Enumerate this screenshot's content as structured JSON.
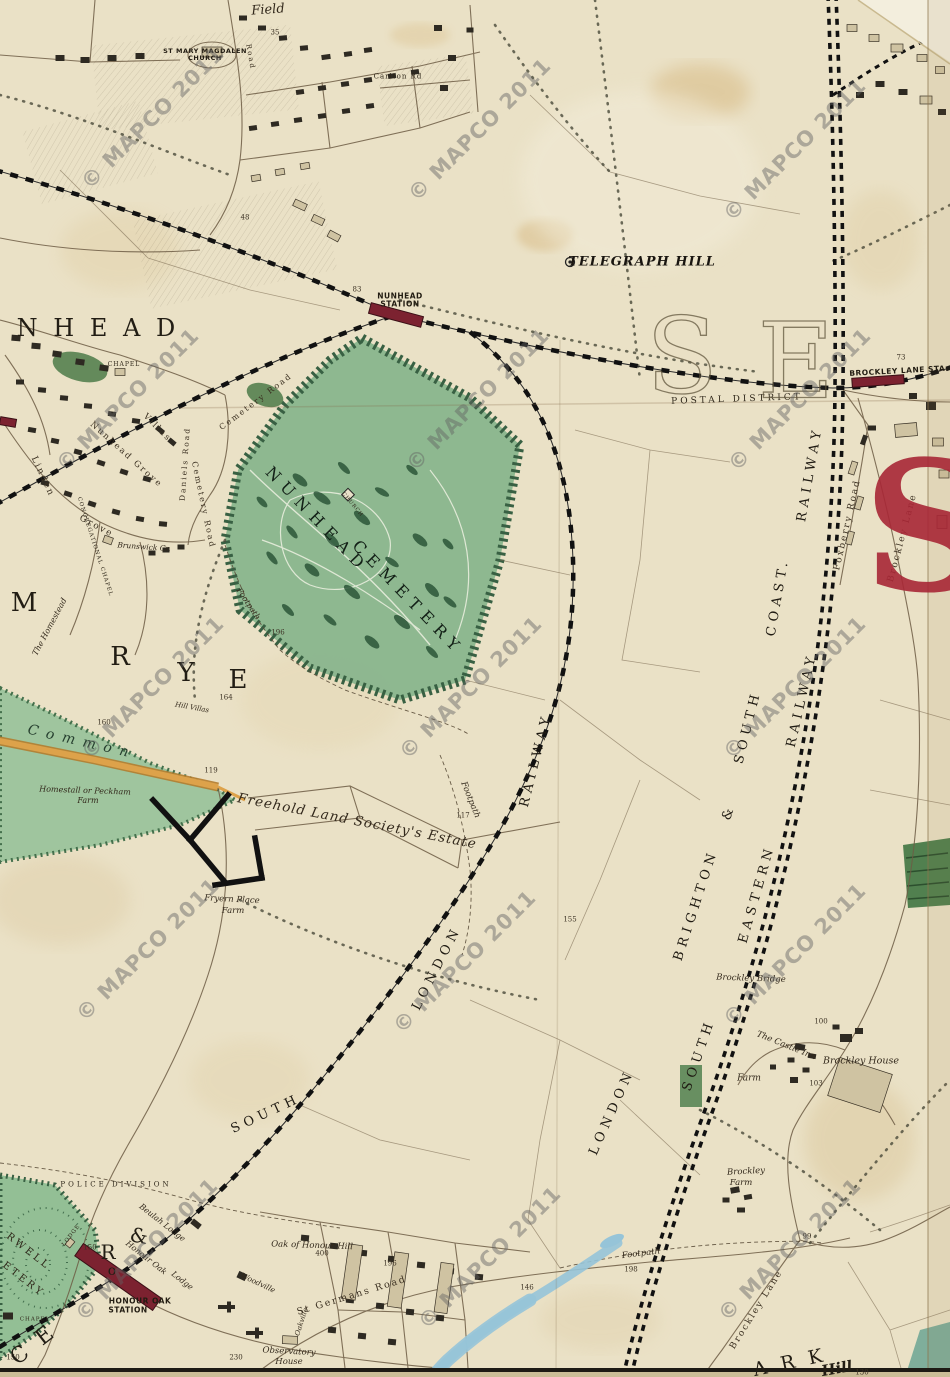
{
  "map": {
    "description": "Victorian map sheet: Nunhead / Telegraph Hill / Brockley / Honour Oak",
    "colors": {
      "paper": "#eae1c6",
      "cemetery_green": "#8ab68e",
      "common_green": "#9cc49c",
      "dark_green": "#51804f",
      "station_red": "#7c2230",
      "postal_red": "#a82736",
      "road_orange": "#d89a3c",
      "stream_blue": "#96c4d8",
      "ink": "#33291c",
      "watermark_gray": "#626262"
    },
    "watermark": {
      "text": "© MAPCO 2011",
      "positions": [
        [
          153,
          118
        ],
        [
          480,
          130
        ],
        [
          795,
          150
        ],
        [
          128,
          400
        ],
        [
          478,
          400
        ],
        [
          800,
          400
        ],
        [
          153,
          688
        ],
        [
          471,
          688
        ],
        [
          795,
          688
        ],
        [
          148,
          950
        ],
        [
          465,
          962
        ],
        [
          795,
          955
        ],
        [
          147,
          1250
        ],
        [
          490,
          1258
        ],
        [
          790,
          1250
        ]
      ]
    },
    "labels": [
      {
        "n": "field-label",
        "t": "Field",
        "x": 268,
        "y": 10,
        "r": -4,
        "s": 13,
        "c": "it"
      },
      {
        "n": "st-mary-church-label-1",
        "t": "ST MARY MAGDALEN",
        "x": 205,
        "y": 51,
        "r": 0,
        "s": 6.5,
        "c": "stn"
      },
      {
        "n": "st-mary-church-label-2",
        "t": "CHURCH",
        "x": 205,
        "y": 58,
        "r": 0,
        "s": 6.5,
        "c": "stn"
      },
      {
        "n": "road-label-nw",
        "t": "Road",
        "x": 250,
        "y": 57,
        "r": 80,
        "s": 7,
        "c": "rd"
      },
      {
        "n": "carlton-rd-label",
        "t": "Carlton Rd",
        "x": 398,
        "y": 77,
        "r": 0,
        "s": 7,
        "c": "tinycaps"
      },
      {
        "n": "num-35",
        "t": "35",
        "x": 275,
        "y": 33,
        "r": 0,
        "s": 7,
        "c": "num"
      },
      {
        "n": "num-48",
        "t": "48",
        "x": 245,
        "y": 218,
        "r": 0,
        "s": 7,
        "c": "num"
      },
      {
        "n": "telegraph-hill-label",
        "t": "TELEGRAPH HILL",
        "x": 642,
        "y": 262,
        "r": 0,
        "s": 13,
        "c": "tg"
      },
      {
        "n": "nunhead-station-label-1",
        "t": "NUNHEAD",
        "x": 400,
        "y": 296,
        "r": 0,
        "s": 7.5,
        "c": "stn"
      },
      {
        "n": "nunhead-station-label-2",
        "t": "STATION",
        "x": 400,
        "y": 304,
        "r": 0,
        "s": 7.5,
        "c": "stn"
      },
      {
        "n": "num-83",
        "t": "83",
        "x": 357,
        "y": 290,
        "r": 0,
        "s": 7,
        "c": "num"
      },
      {
        "n": "unhead-district-letters",
        "t": "U N H E A D",
        "x": 80,
        "y": 328,
        "r": 0,
        "s": 24,
        "c": "big"
      },
      {
        "n": "chapel-label-1",
        "t": "CHAPEL",
        "x": 124,
        "y": 365,
        "r": 0,
        "s": 6,
        "c": "tinycaps"
      },
      {
        "n": "brockley-lane-sta-label",
        "t": "BROCKLEY LANE STA.",
        "x": 899,
        "y": 371,
        "r": -3,
        "s": 7.5,
        "c": "stn"
      },
      {
        "n": "num-73",
        "t": "73",
        "x": 901,
        "y": 358,
        "r": 0,
        "s": 7,
        "c": "num"
      },
      {
        "n": "postal-district-label",
        "t": "POSTAL DISTRICT",
        "x": 737,
        "y": 400,
        "r": -2,
        "s": 9,
        "c": "sp"
      },
      {
        "n": "se-letter-s-outline",
        "t": "S",
        "x": 683,
        "y": 357,
        "r": 0,
        "s": 105,
        "c": "hollow"
      },
      {
        "n": "se-letter-e-outline",
        "t": "E",
        "x": 797,
        "y": 362,
        "r": 0,
        "s": 105,
        "c": "hollow"
      },
      {
        "n": "nunhead-cemetery-label-1",
        "t": "NUNHEAD",
        "x": 317,
        "y": 520,
        "r": 46,
        "s": 16,
        "c": "cem"
      },
      {
        "n": "nunhead-cemetery-label-2",
        "t": "CEMETERY",
        "x": 408,
        "y": 598,
        "r": 46,
        "s": 16,
        "c": "cem"
      },
      {
        "n": "cemetery-church-label",
        "t": "CHURCH",
        "x": 352,
        "y": 505,
        "r": 50,
        "s": 5,
        "c": "tinycaps"
      },
      {
        "n": "cemetery-road-label-1",
        "t": "Cemetery Road",
        "x": 256,
        "y": 402,
        "r": -37,
        "s": 8,
        "c": "rd"
      },
      {
        "n": "cemetery-road-label-2",
        "t": "Cemetery Road",
        "x": 203,
        "y": 505,
        "r": 78,
        "s": 8,
        "c": "rd"
      },
      {
        "n": "linden-grove-label-1",
        "t": "Linden",
        "x": 42,
        "y": 477,
        "r": 65,
        "s": 9,
        "c": "rd"
      },
      {
        "n": "linden-grove-label-2",
        "t": "Grove",
        "x": 96,
        "y": 527,
        "r": 28,
        "s": 9,
        "c": "rd"
      },
      {
        "n": "nunhead-grove-label",
        "t": "Nunhead Grove",
        "x": 126,
        "y": 455,
        "r": 42,
        "s": 8.5,
        "c": "rd"
      },
      {
        "n": "villas-label",
        "t": "Villas",
        "x": 157,
        "y": 428,
        "r": 45,
        "s": 8.5,
        "c": "rd"
      },
      {
        "n": "daniels-road-label",
        "t": "Daniels Road",
        "x": 185,
        "y": 464,
        "r": -86,
        "s": 7.5,
        "c": "rd"
      },
      {
        "n": "congregational-chapel-label",
        "t": "CONGREGATIONAL CHAPEL",
        "x": 94,
        "y": 547,
        "r": 72,
        "s": 5.5,
        "c": "tinycaps"
      },
      {
        "n": "brunswick-cr-label",
        "t": "Brunswick Cr.",
        "x": 144,
        "y": 547,
        "r": 4,
        "s": 7.5,
        "c": "it"
      },
      {
        "n": "rye-letter-m",
        "t": "M",
        "x": 26,
        "y": 603,
        "r": 0,
        "s": 26,
        "c": "big"
      },
      {
        "n": "rye-letter-r",
        "t": "R",
        "x": 122,
        "y": 657,
        "r": 0,
        "s": 26,
        "c": "big"
      },
      {
        "n": "rye-letter-y",
        "t": "Y",
        "x": 188,
        "y": 673,
        "r": 0,
        "s": 26,
        "c": "big"
      },
      {
        "n": "rye-letter-e",
        "t": "E",
        "x": 240,
        "y": 680,
        "r": 0,
        "s": 26,
        "c": "big"
      },
      {
        "n": "homestead-label",
        "t": "The Homestead",
        "x": 50,
        "y": 627,
        "r": -62,
        "s": 8,
        "c": "it"
      },
      {
        "n": "common-label",
        "t": "Common",
        "x": 82,
        "y": 742,
        "r": 13,
        "s": 14,
        "c": "common"
      },
      {
        "n": "homestall-farm-label-1",
        "t": "Homestall or Peckham",
        "x": 85,
        "y": 791,
        "r": 2,
        "s": 8,
        "c": "it"
      },
      {
        "n": "homestall-farm-label-2",
        "t": "Farm",
        "x": 88,
        "y": 801,
        "r": 0,
        "s": 8,
        "c": "it"
      },
      {
        "n": "hill-villas-label",
        "t": "Hill Villas",
        "x": 192,
        "y": 708,
        "r": 10,
        "s": 7,
        "c": "it"
      },
      {
        "n": "num-164",
        "t": "164",
        "x": 226,
        "y": 698,
        "r": 0,
        "s": 7,
        "c": "num"
      },
      {
        "n": "num-160",
        "t": "160",
        "x": 104,
        "y": 723,
        "r": 0,
        "s": 7,
        "c": "num"
      },
      {
        "n": "num-119",
        "t": "119",
        "x": 211,
        "y": 771,
        "r": 0,
        "s": 7,
        "c": "num"
      },
      {
        "n": "footpath-label-1",
        "t": "Footpath",
        "x": 248,
        "y": 604,
        "r": 56,
        "s": 8,
        "c": "it"
      },
      {
        "n": "num-196-cemetery",
        "t": "196",
        "x": 278,
        "y": 633,
        "r": 0,
        "s": 7,
        "c": "num"
      },
      {
        "n": "footpath-label-2",
        "t": "Footpath",
        "x": 470,
        "y": 800,
        "r": 68,
        "s": 8.5,
        "c": "it"
      },
      {
        "n": "num-117",
        "t": "117",
        "x": 463,
        "y": 816,
        "r": 0,
        "s": 7,
        "c": "num"
      },
      {
        "n": "fryern-place-farm-label-1",
        "t": "Fryern Place",
        "x": 232,
        "y": 900,
        "r": 3,
        "s": 8.5,
        "c": "it"
      },
      {
        "n": "fryern-place-farm-label-2",
        "t": "Farm",
        "x": 233,
        "y": 911,
        "r": 0,
        "s": 8.5,
        "c": "it"
      },
      {
        "n": "freehold-estate-label",
        "t": "Freehold Land Society's Estate",
        "x": 357,
        "y": 822,
        "r": 11,
        "s": 13.5,
        "c": "est"
      },
      {
        "n": "south-london-railway-label-1",
        "t": "SOUTH",
        "x": 266,
        "y": 1114,
        "r": -25,
        "s": 13,
        "c": "rly"
      },
      {
        "n": "south-london-railway-label-2",
        "t": "LONDON",
        "x": 437,
        "y": 968,
        "r": -63,
        "s": 13,
        "c": "rly"
      },
      {
        "n": "south-london-railway-label-3",
        "t": "RAILWAY",
        "x": 536,
        "y": 760,
        "r": -76,
        "s": 13,
        "c": "rly"
      },
      {
        "n": "lbscr-label-london",
        "t": "LONDON",
        "x": 612,
        "y": 1112,
        "r": -66,
        "s": 13,
        "c": "rly"
      },
      {
        "n": "lbscr-label-brighton",
        "t": "BRIGHTON",
        "x": 696,
        "y": 905,
        "r": -72,
        "s": 13,
        "c": "rly"
      },
      {
        "n": "lbscr-label-ampersand",
        "t": "&",
        "x": 729,
        "y": 812,
        "r": -72,
        "s": 13,
        "c": "rly"
      },
      {
        "n": "lbscr-label-south",
        "t": "SOUTH",
        "x": 748,
        "y": 727,
        "r": -76,
        "s": 13,
        "c": "rly"
      },
      {
        "n": "lbscr-label-coast",
        "t": "COAST.",
        "x": 778,
        "y": 597,
        "r": -80,
        "s": 13,
        "c": "rly"
      },
      {
        "n": "lbscr-label-railway",
        "t": "RAILWAY",
        "x": 810,
        "y": 474,
        "r": -80,
        "s": 13,
        "c": "rly"
      },
      {
        "n": "ser-label-south",
        "t": "SOUTH",
        "x": 699,
        "y": 1055,
        "r": -71,
        "s": 13,
        "c": "rly"
      },
      {
        "n": "ser-label-eastern",
        "t": "EASTERN",
        "x": 757,
        "y": 894,
        "r": -74,
        "s": 13,
        "c": "rly"
      },
      {
        "n": "ser-label-railway",
        "t": "RAILWAY",
        "x": 802,
        "y": 700,
        "r": -77,
        "s": 13,
        "c": "rly"
      },
      {
        "n": "brockley-bridge-label",
        "t": "Brockley Bridge",
        "x": 751,
        "y": 979,
        "r": 2,
        "s": 8.5,
        "c": "it"
      },
      {
        "n": "castle-inn-label",
        "t": "The Castle Inn",
        "x": 786,
        "y": 1046,
        "r": 22,
        "s": 8.5,
        "c": "it"
      },
      {
        "n": "farm-label",
        "t": "Farm",
        "x": 749,
        "y": 1079,
        "r": 0,
        "s": 9,
        "c": "it"
      },
      {
        "n": "brockley-house-label",
        "t": "Brockley House",
        "x": 861,
        "y": 1061,
        "r": 0,
        "s": 9.5,
        "c": "it"
      },
      {
        "n": "num-100",
        "t": "100",
        "x": 821,
        "y": 1022,
        "r": 0,
        "s": 7,
        "c": "num"
      },
      {
        "n": "num-103",
        "t": "103",
        "x": 816,
        "y": 1084,
        "r": 0,
        "s": 7,
        "c": "num"
      },
      {
        "n": "num-155",
        "t": "155",
        "x": 570,
        "y": 920,
        "r": 0,
        "s": 7,
        "c": "num"
      },
      {
        "n": "brockley-farm-label-1",
        "t": "Brockley",
        "x": 746,
        "y": 1172,
        "r": -3,
        "s": 8.5,
        "c": "it"
      },
      {
        "n": "brockley-farm-label-2",
        "t": "Farm",
        "x": 741,
        "y": 1183,
        "r": 0,
        "s": 8.5,
        "c": "it"
      },
      {
        "n": "police-division-label",
        "t": "POLICE DIVISION",
        "x": 116,
        "y": 1185,
        "r": 0,
        "s": 7,
        "c": "sp"
      },
      {
        "n": "honour-oak-station-label-1",
        "t": "HONOUR OAK",
        "x": 140,
        "y": 1301,
        "r": 0,
        "s": 7.5,
        "c": "stn"
      },
      {
        "n": "honour-oak-station-label-2",
        "t": "STATION",
        "x": 128,
        "y": 1310,
        "r": 0,
        "s": 7.5,
        "c": "stn"
      },
      {
        "n": "beulah-lodge-label",
        "t": "Beulah Lodge",
        "x": 162,
        "y": 1223,
        "r": 38,
        "s": 8,
        "c": "it"
      },
      {
        "n": "honour-oak-lodge-label-1",
        "t": "Honour Oak",
        "x": 146,
        "y": 1258,
        "r": 38,
        "s": 8,
        "c": "it"
      },
      {
        "n": "honour-oak-lodge-label-2",
        "t": "Lodge",
        "x": 182,
        "y": 1281,
        "r": 38,
        "s": 8,
        "c": "it"
      },
      {
        "n": "frag-ampersand",
        "t": "&",
        "x": 141,
        "y": 1236,
        "r": 10,
        "s": 20,
        "c": "big"
      },
      {
        "n": "frag-letter-r",
        "t": "R",
        "x": 110,
        "y": 1252,
        "r": 0,
        "s": 20,
        "c": "big"
      },
      {
        "n": "frag-letter-o",
        "t": "o",
        "x": 114,
        "y": 1271,
        "r": 0,
        "s": 14,
        "c": "big"
      },
      {
        "n": "oak-of-honour-hill-label",
        "t": "Oak of Honour Hill",
        "x": 312,
        "y": 1246,
        "r": 2,
        "s": 8.5,
        "c": "it"
      },
      {
        "n": "num-400",
        "t": "400",
        "x": 322,
        "y": 1254,
        "r": 0,
        "s": 7,
        "c": "num"
      },
      {
        "n": "woodville-label",
        "t": "Woodville",
        "x": 258,
        "y": 1283,
        "r": 25,
        "s": 7.5,
        "c": "it"
      },
      {
        "n": "oakville-label",
        "t": "Oakville",
        "x": 302,
        "y": 1322,
        "r": -72,
        "s": 7,
        "c": "it"
      },
      {
        "n": "st-germans-road-label",
        "t": "St Germans Road",
        "x": 352,
        "y": 1296,
        "r": -17,
        "s": 9.5,
        "c": "rd"
      },
      {
        "n": "observatory-house-label-1",
        "t": "Observatory",
        "x": 289,
        "y": 1352,
        "r": 3,
        "s": 8.5,
        "c": "it"
      },
      {
        "n": "observatory-house-label-2",
        "t": "House",
        "x": 289,
        "y": 1362,
        "r": 0,
        "s": 8.5,
        "c": "it"
      },
      {
        "n": "num-230",
        "t": "230",
        "x": 236,
        "y": 1358,
        "r": 0,
        "s": 7,
        "c": "num"
      },
      {
        "n": "footpath-label-3",
        "t": "Footpath",
        "x": 641,
        "y": 1254,
        "r": -7,
        "s": 8.5,
        "c": "it"
      },
      {
        "n": "num-198",
        "t": "198",
        "x": 631,
        "y": 1270,
        "r": 0,
        "s": 7,
        "c": "num"
      },
      {
        "n": "num-196-road",
        "t": "196",
        "x": 390,
        "y": 1264,
        "r": 0,
        "s": 7,
        "c": "num"
      },
      {
        "n": "num-146",
        "t": "146",
        "x": 527,
        "y": 1288,
        "r": 0,
        "s": 7,
        "c": "num"
      },
      {
        "n": "num-99",
        "t": "99",
        "x": 807,
        "y": 1237,
        "r": 0,
        "s": 7,
        "c": "num"
      },
      {
        "n": "brockley-lane-label-south",
        "t": "Brockley Lane",
        "x": 757,
        "y": 1310,
        "r": -58,
        "s": 9,
        "c": "rd"
      },
      {
        "n": "brockley-lane-label-north",
        "t": "Brockley Lane",
        "x": 903,
        "y": 538,
        "r": -75,
        "s": 9,
        "c": "rd"
      },
      {
        "n": "foxberry-road-label",
        "t": "Foxberry Road",
        "x": 848,
        "y": 525,
        "r": -77,
        "s": 9,
        "c": "rd"
      },
      {
        "n": "se-red-letter-s",
        "t": "S",
        "x": 928,
        "y": 528,
        "r": 0,
        "s": 180,
        "c": "redS"
      },
      {
        "n": "camberwell-cemetery-label-1",
        "t": "RWELL",
        "x": 28,
        "y": 1252,
        "r": 38,
        "s": 10,
        "c": "sp"
      },
      {
        "n": "camberwell-cemetery-label-2",
        "t": "ETERY",
        "x": 23,
        "y": 1280,
        "r": 38,
        "s": 10,
        "c": "sp"
      },
      {
        "n": "cemetery-lodge-label",
        "t": "LODGE",
        "x": 72,
        "y": 1236,
        "r": -52,
        "s": 5.5,
        "c": "tinycaps"
      },
      {
        "n": "chapel-label-2",
        "t": "CHAPEL",
        "x": 35,
        "y": 1320,
        "r": 0,
        "s": 5.5,
        "c": "tinycaps"
      },
      {
        "n": "num-150a",
        "t": "150",
        "x": 90,
        "y": 1248,
        "r": 0,
        "s": 7,
        "c": "num"
      },
      {
        "n": "num-150b",
        "t": "150",
        "x": 13,
        "y": 1358,
        "r": 0,
        "s": 7,
        "c": "num"
      },
      {
        "n": "frag-ce",
        "t": "C E",
        "x": 34,
        "y": 1345,
        "r": -38,
        "s": 22,
        "c": "big"
      },
      {
        "n": "frag-ark",
        "t": "A R K",
        "x": 790,
        "y": 1363,
        "r": -12,
        "s": 19,
        "c": "big"
      },
      {
        "n": "frag-hill",
        "t": "Hill",
        "x": 837,
        "y": 1369,
        "r": -10,
        "s": 15,
        "c": "bigit"
      },
      {
        "n": "num-130",
        "t": "130",
        "x": 862,
        "y": 1373,
        "r": 0,
        "s": 7,
        "c": "num"
      }
    ]
  }
}
